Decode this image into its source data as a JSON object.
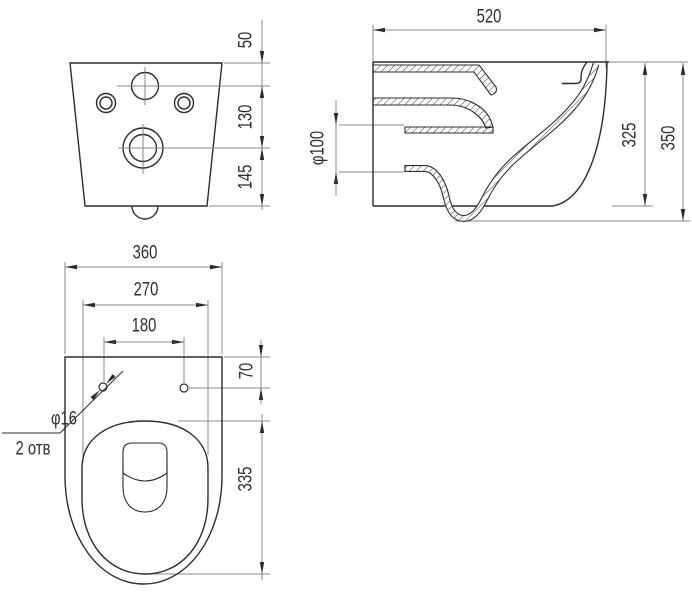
{
  "drawing": {
    "front_view": {
      "dim_50": "50",
      "dim_130": "130",
      "dim_145": "145"
    },
    "side_view": {
      "dim_520": "520",
      "dim_diameter_100": "φ100",
      "dim_325": "325",
      "dim_350": "350"
    },
    "top_view": {
      "dim_360": "360",
      "dim_270": "270",
      "dim_180": "180",
      "dim_70": "70",
      "dim_335": "335",
      "dim_diameter_16": "φ16",
      "dim_holes_count": "2 отв"
    },
    "colors": {
      "background": "#ffffff",
      "contour": "#2c2c2c",
      "dimension_line": "#8a8a8a",
      "text": "#2e2e2e"
    }
  }
}
